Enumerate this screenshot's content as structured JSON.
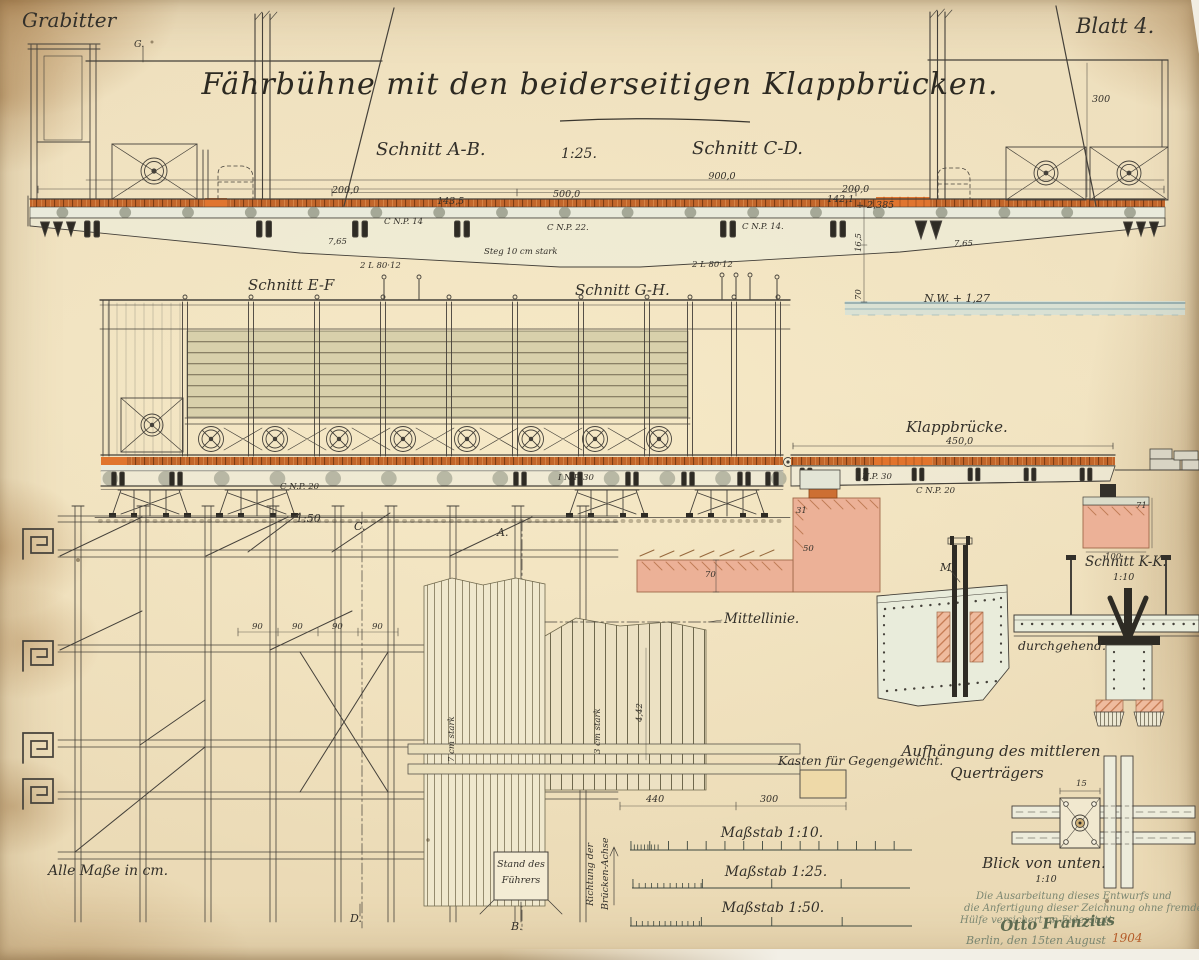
{
  "colors": {
    "paper": "#efe1bf",
    "ink": "#33302a",
    "line_ink": "#45413a",
    "deck_orange": "#c2662b",
    "bright_orange": "#e0752f",
    "masonry_pink": "#ecb197",
    "steel_fill": "#e9ecdb",
    "water_blue": "#5e8390",
    "attestation_green": "#7a8671",
    "signature_green": "#5c6a50",
    "year_red": "#b55c2a"
  },
  "labels": [
    {
      "name": "corner-author",
      "text": "Grabitter",
      "x": 22,
      "y": 10,
      "cls": "t-script20"
    },
    {
      "name": "sheet-number",
      "text": "Blatt 4.",
      "x": 1076,
      "y": 16,
      "cls": "t-script21"
    },
    {
      "name": "drawing-title",
      "text": "Fährbühne mit den beiderseitigen Klappbrücken.",
      "x": 600,
      "y": 70,
      "cls": "t-title",
      "anchor": "m"
    },
    {
      "name": "section-ab",
      "text": "Schnitt A-B.",
      "x": 376,
      "y": 141,
      "cls": "t-h18"
    },
    {
      "name": "scale-1-25",
      "text": "1:25.",
      "x": 561,
      "y": 147,
      "cls": "t-h14"
    },
    {
      "name": "section-cd",
      "text": "Schnitt C-D.",
      "x": 692,
      "y": 140,
      "cls": "t-h18"
    },
    {
      "name": "dim-900",
      "text": "900,0",
      "x": 722,
      "y": 172,
      "cls": "t-d9",
      "anchor": "m"
    },
    {
      "name": "dim-200-left",
      "text": "200,0",
      "x": 332,
      "y": 186,
      "cls": "t-d9"
    },
    {
      "name": "dim-143-5",
      "text": "143,5",
      "x": 437,
      "y": 197,
      "cls": "t-d9"
    },
    {
      "name": "dim-500",
      "text": "500,0",
      "x": 553,
      "y": 190,
      "cls": "t-d9"
    },
    {
      "name": "dim-142-1",
      "text": "142,1",
      "x": 827,
      "y": 195,
      "cls": "t-d9"
    },
    {
      "name": "dim-200-right",
      "text": "200,0",
      "x": 842,
      "y": 185,
      "cls": "t-d9"
    },
    {
      "name": "dim-plus-2385",
      "text": "+ 2,385",
      "x": 856,
      "y": 201,
      "cls": "t-d9"
    },
    {
      "name": "dim-300-height",
      "text": "300",
      "x": 1092,
      "y": 95,
      "cls": "t-d9"
    },
    {
      "name": "marker-g",
      "text": "G.",
      "x": 134,
      "y": 40,
      "cls": "t-d9"
    },
    {
      "name": "waterline-label",
      "text": "N.W. + 1,27",
      "x": 924,
      "y": 293,
      "cls": "t-s11"
    },
    {
      "name": "profile-cnp14-left",
      "text": "C N.P. 14",
      "x": 384,
      "y": 218,
      "cls": "t-t8"
    },
    {
      "name": "profile-cnp22",
      "text": "C N.P. 22.",
      "x": 547,
      "y": 224,
      "cls": "t-t8"
    },
    {
      "name": "profile-cnp14-right",
      "text": "C N.P. 14.",
      "x": 742,
      "y": 223,
      "cls": "t-t8"
    },
    {
      "name": "web-note",
      "text": "Steg 10 cm stark",
      "x": 484,
      "y": 248,
      "cls": "t-t8"
    },
    {
      "name": "angle-80-12-left",
      "text": "2 L 80·12",
      "x": 360,
      "y": 262,
      "cls": "t-t8"
    },
    {
      "name": "angle-80-12-right",
      "text": "2 L 80·12",
      "x": 692,
      "y": 261,
      "cls": "t-t8"
    },
    {
      "name": "dim-765-left",
      "text": "7,65",
      "x": 328,
      "y": 238,
      "cls": "t-t8"
    },
    {
      "name": "dim-765-right",
      "text": "7,65",
      "x": 954,
      "y": 240,
      "cls": "t-t8"
    },
    {
      "name": "dim-165-vert",
      "text": "16,5",
      "x": 855,
      "y": 252,
      "cls": "t-t8",
      "rot": -90
    },
    {
      "name": "dim-70-vert",
      "text": "70",
      "x": 855,
      "y": 300,
      "cls": "t-t8",
      "rot": -90
    },
    {
      "name": "section-ef",
      "text": "Schnitt E-F",
      "x": 248,
      "y": 278,
      "cls": "t-h15"
    },
    {
      "name": "section-gh",
      "text": "Schnitt G-H.",
      "x": 575,
      "y": 283,
      "cls": "t-h15"
    },
    {
      "name": "klappbruecke-title",
      "text": "Klappbrücke.",
      "x": 906,
      "y": 420,
      "cls": "t-h15"
    },
    {
      "name": "dim-450",
      "text": "450,0",
      "x": 946,
      "y": 437,
      "cls": "t-d9"
    },
    {
      "name": "profile-inp30-left",
      "text": "I N.P. 30",
      "x": 558,
      "y": 474,
      "cls": "t-t8"
    },
    {
      "name": "profile-cnp20-left",
      "text": "C N.P. 20",
      "x": 280,
      "y": 483,
      "cls": "t-t8"
    },
    {
      "name": "profile-inp30-right",
      "text": "I N.P. 30",
      "x": 856,
      "y": 473,
      "cls": "t-t8"
    },
    {
      "name": "profile-cnp20-right",
      "text": "C N.P. 20",
      "x": 916,
      "y": 487,
      "cls": "t-t8"
    },
    {
      "name": "dim-31",
      "text": "31",
      "x": 796,
      "y": 507,
      "cls": "t-t8"
    },
    {
      "name": "dim-50",
      "text": "50",
      "x": 803,
      "y": 545,
      "cls": "t-t8"
    },
    {
      "name": "dim-70-wall",
      "text": "70",
      "x": 705,
      "y": 571,
      "cls": "t-t8"
    },
    {
      "name": "dim-100",
      "text": "100",
      "x": 1105,
      "y": 553,
      "cls": "t-t8"
    },
    {
      "name": "dim-71",
      "text": "71",
      "x": 1136,
      "y": 502,
      "cls": "t-t8"
    },
    {
      "name": "scale-1-50",
      "text": "1:50",
      "x": 296,
      "y": 513,
      "cls": "t-s11"
    },
    {
      "name": "marker-c",
      "text": "C.",
      "x": 354,
      "y": 521,
      "cls": "t-s11"
    },
    {
      "name": "marker-a",
      "text": "A.",
      "x": 497,
      "y": 527,
      "cls": "t-s11"
    },
    {
      "name": "marker-d",
      "text": "D.",
      "x": 350,
      "y": 913,
      "cls": "t-s11"
    },
    {
      "name": "marker-b",
      "text": "B.",
      "x": 511,
      "y": 921,
      "cls": "t-s11"
    },
    {
      "name": "dim-90-1",
      "text": "90",
      "x": 252,
      "y": 623,
      "cls": "t-t8"
    },
    {
      "name": "dim-90-2",
      "text": "90",
      "x": 292,
      "y": 623,
      "cls": "t-t8"
    },
    {
      "name": "dim-90-3",
      "text": "90",
      "x": 332,
      "y": 623,
      "cls": "t-t8"
    },
    {
      "name": "dim-90-4",
      "text": "90",
      "x": 372,
      "y": 623,
      "cls": "t-t8"
    },
    {
      "name": "mittellinie",
      "text": "Mittellinie.",
      "x": 724,
      "y": 613,
      "cls": "t-h13"
    },
    {
      "name": "plank-7cm",
      "text": "7 cm stark",
      "x": 448,
      "y": 762,
      "cls": "t-t8",
      "rot": -90
    },
    {
      "name": "plank-3cm",
      "text": "3 cm stark",
      "x": 594,
      "y": 754,
      "cls": "t-t8",
      "rot": -90
    },
    {
      "name": "dim-442",
      "text": "4,42",
      "x": 636,
      "y": 722,
      "cls": "t-t8",
      "rot": -90
    },
    {
      "name": "kasten-label",
      "text": "Kasten für Gegengewicht.",
      "x": 778,
      "y": 755,
      "cls": "t-h12"
    },
    {
      "name": "dim-440",
      "text": "440",
      "x": 646,
      "y": 795,
      "cls": "t-d9"
    },
    {
      "name": "dim-300-kasten",
      "text": "300",
      "x": 760,
      "y": 795,
      "cls": "t-d9"
    },
    {
      "name": "richtung-line1",
      "text": "Richtung der",
      "x": 586,
      "y": 906,
      "cls": "t-d9",
      "rot": -90
    },
    {
      "name": "richtung-line2",
      "text": "Brücken-Achse",
      "x": 601,
      "y": 910,
      "cls": "t-d9",
      "rot": -90
    },
    {
      "name": "stand-line1",
      "text": "Stand des",
      "x": 521,
      "y": 860,
      "cls": "t-t9",
      "anchor": "m"
    },
    {
      "name": "stand-line2",
      "text": "Führers",
      "x": 521,
      "y": 876,
      "cls": "t-t9",
      "anchor": "m"
    },
    {
      "name": "section-kk",
      "text": "Schnitt K-K.",
      "x": 1085,
      "y": 556,
      "cls": "t-h13"
    },
    {
      "name": "scale-kk",
      "text": "1:10",
      "x": 1113,
      "y": 573,
      "cls": "t-d9"
    },
    {
      "name": "marker-m",
      "text": "M.",
      "x": 940,
      "y": 562,
      "cls": "t-s11"
    },
    {
      "name": "durchgehend",
      "text": "durchgehend.",
      "x": 1018,
      "y": 640,
      "cls": "t-h12"
    },
    {
      "name": "aufhaengung-line1",
      "text": "Aufhängung des mittleren",
      "x": 1001,
      "y": 744,
      "cls": "t-h15",
      "anchor": "m"
    },
    {
      "name": "aufhaengung-line2",
      "text": "Querträgers",
      "x": 997,
      "y": 766,
      "cls": "t-h15",
      "anchor": "m"
    },
    {
      "name": "blick-label",
      "text": "Blick von unten.",
      "x": 1044,
      "y": 856,
      "cls": "t-h15",
      "anchor": "m"
    },
    {
      "name": "blick-scale",
      "text": "1:10",
      "x": 1046,
      "y": 875,
      "cls": "t-d9",
      "anchor": "m"
    },
    {
      "name": "dim-15",
      "text": "15",
      "x": 1076,
      "y": 780,
      "cls": "t-t8"
    },
    {
      "name": "massstab-10",
      "text": "Maßstab 1:10.",
      "x": 772,
      "y": 826,
      "cls": "t-h14",
      "anchor": "m"
    },
    {
      "name": "massstab-25",
      "text": "Maßstab 1:25.",
      "x": 776,
      "y": 865,
      "cls": "t-h14",
      "anchor": "m"
    },
    {
      "name": "massstab-50",
      "text": "Maßstab 1:50.",
      "x": 773,
      "y": 901,
      "cls": "t-h14",
      "anchor": "m"
    },
    {
      "name": "units-note",
      "text": "Alle Maße in cm.",
      "x": 48,
      "y": 864,
      "cls": "t-h14"
    },
    {
      "name": "attestation-line1",
      "text": "Die Ausarbeitung dieses Entwurfs und",
      "x": 976,
      "y": 892,
      "cls": "t-green"
    },
    {
      "name": "attestation-line2",
      "text": "die Anfertigung dieser Zeichnung ohne fremde",
      "x": 964,
      "y": 904,
      "cls": "t-green"
    },
    {
      "name": "attestation-line3",
      "text": "Hülfe versichert an Eidesstatt",
      "x": 960,
      "y": 916,
      "cls": "t-green"
    },
    {
      "name": "signature",
      "text": "Otto Franzius",
      "x": 1000,
      "y": 919,
      "cls": "t-sig",
      "rot": -3
    },
    {
      "name": "date-place",
      "text": "Berlin, den 15ten August",
      "x": 966,
      "y": 935,
      "cls": "t-green2"
    },
    {
      "name": "date-year",
      "text": "1904",
      "x": 1112,
      "y": 932,
      "cls": "t-year"
    }
  ]
}
